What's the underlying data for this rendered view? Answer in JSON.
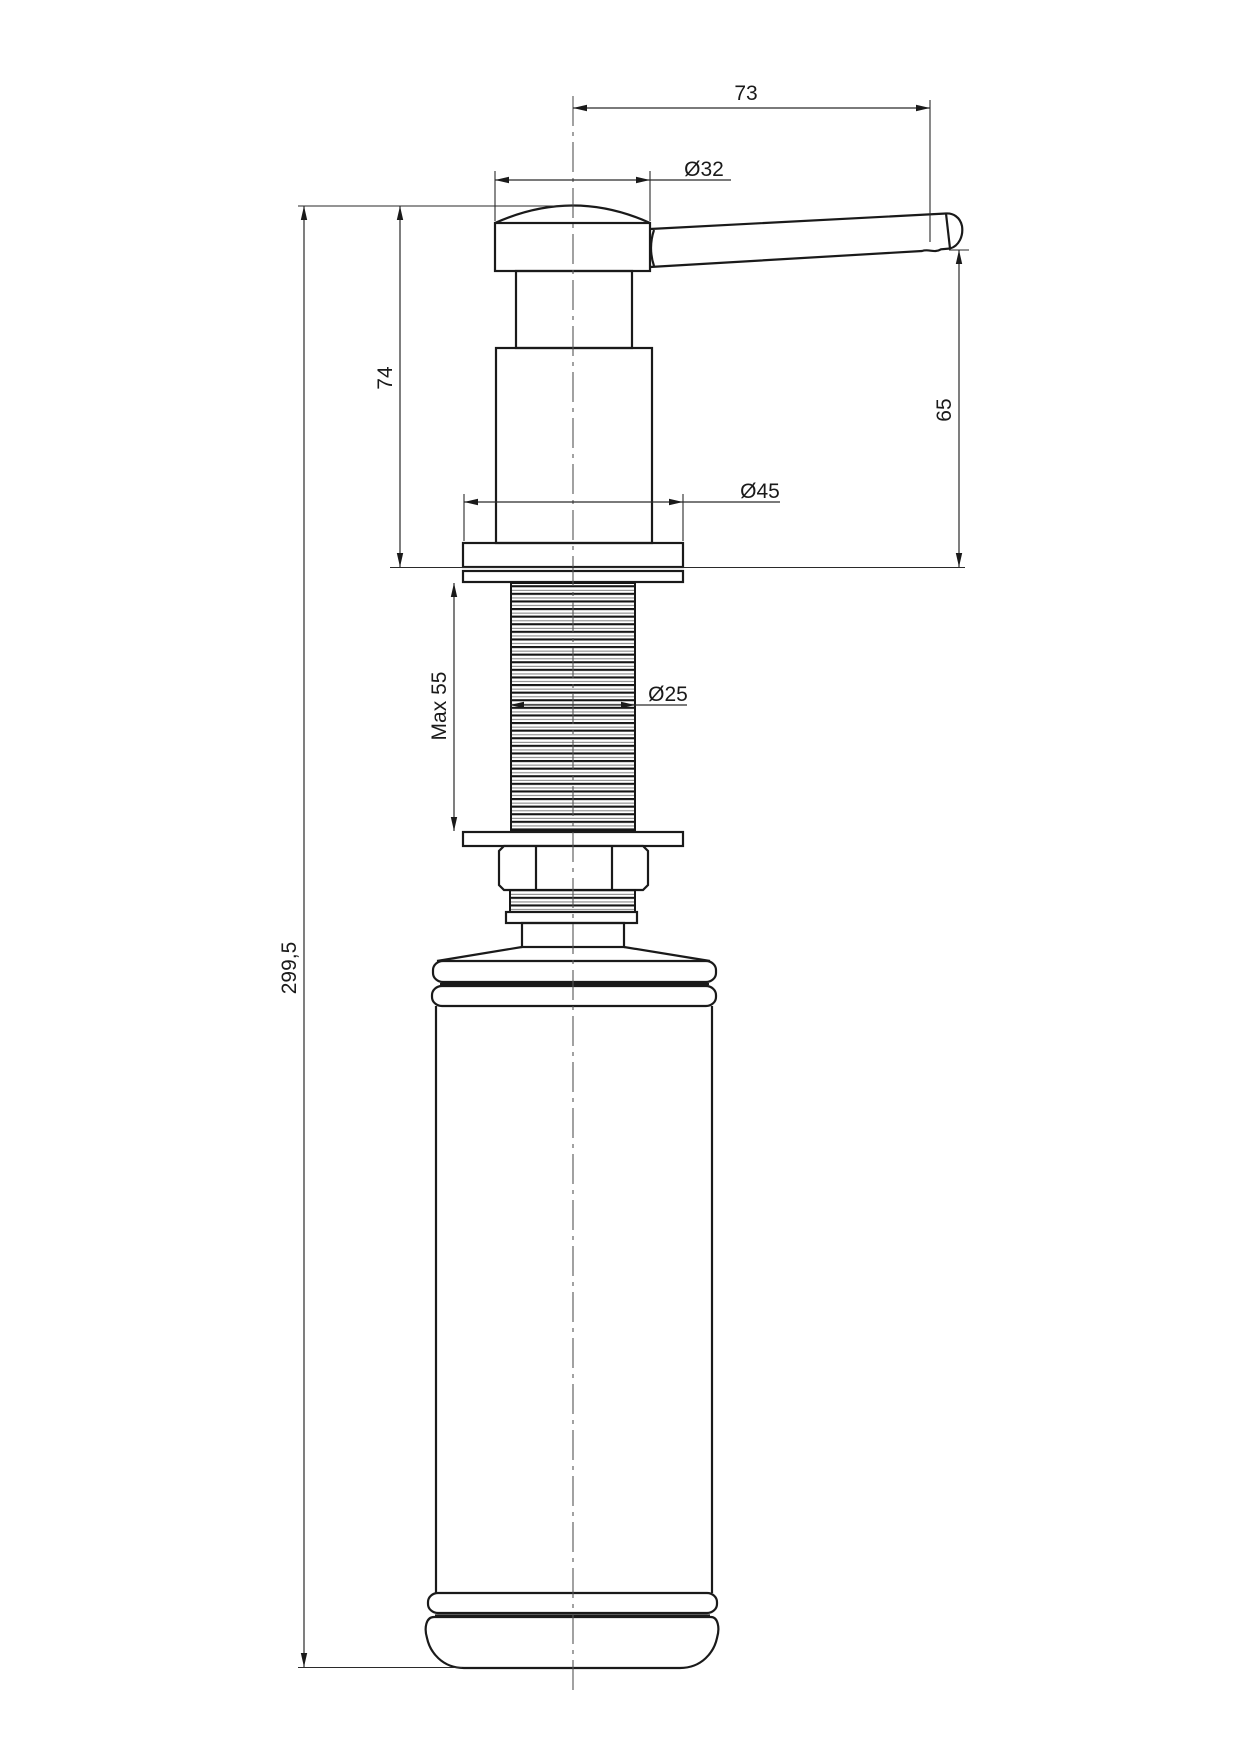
{
  "drawing": {
    "background_color": "#ffffff",
    "line_color": "#1a1a1a",
    "labels": {
      "lever_reach": "73",
      "head_diameter": "Ø32",
      "height_above_counter": "74",
      "spout_height": "65",
      "flange_diameter": "Ø45",
      "max_counter_thickness": "Max 55",
      "thread_diameter": "Ø25",
      "total_height": "299,5"
    }
  }
}
